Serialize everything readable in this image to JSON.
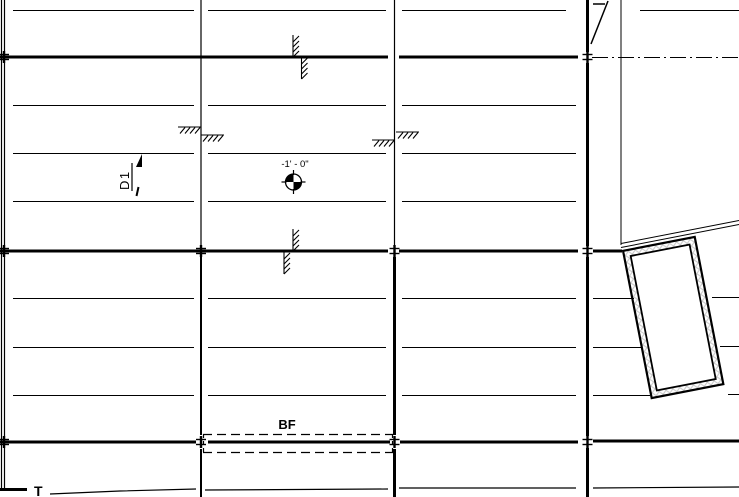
{
  "labels": {
    "detail_marker": "D1",
    "spot_elevation": "-1' - 0\"",
    "footing_tag": "BF",
    "truncated_bottom_text": "T"
  },
  "colors": {
    "line": "#000000",
    "background": "#ffffff",
    "hatch_fill": "#c8c8c8"
  }
}
